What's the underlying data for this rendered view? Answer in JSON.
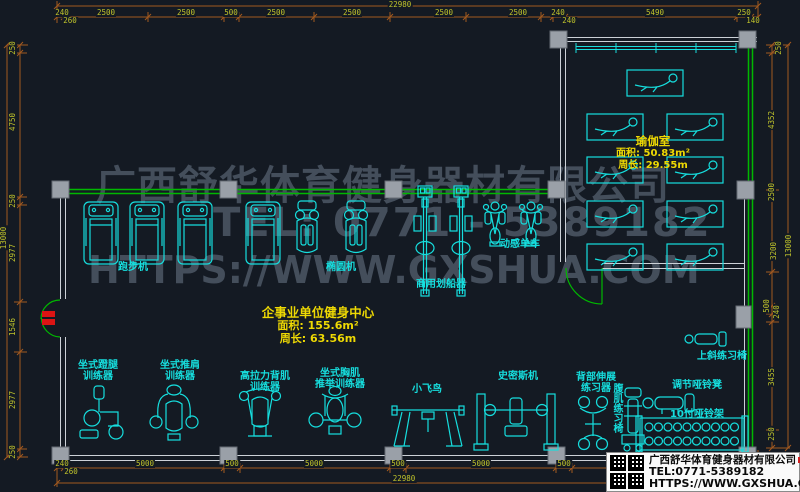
{
  "watermark": {
    "line1": "广西舒华体育健身器材有限公司",
    "line2": "TEL: 0771 - 5389182",
    "line3": "HTTPS://WWW.GXSHUA.COM"
  },
  "rooms": {
    "yoga": {
      "name": "瑜伽室",
      "area": "面积: 50.83m²",
      "perimeter": "周长: 29.55m"
    },
    "main": {
      "name": "企事业单位健身中心",
      "area": "面积: 155.6m²",
      "perimeter": "周长: 63.56m"
    }
  },
  "title_block": {
    "company": "广西舒华体育健身器材有限公司",
    "tel": "TEL:0771-5389182",
    "url": "HTTPS://WWW.GXSHUA.COM"
  },
  "equipment_labels": [
    {
      "text": "跑步机",
      "x": 133,
      "y": 262
    },
    {
      "text": "椭圆机",
      "x": 341,
      "y": 262
    },
    {
      "text": "商用划船器",
      "x": 441,
      "y": 279
    },
    {
      "text": "动感单车",
      "x": 520,
      "y": 239
    },
    {
      "text": "坐式蹬腿\n训练器",
      "x": 98,
      "y": 360
    },
    {
      "text": "坐式推肩\n训练器",
      "x": 180,
      "y": 360
    },
    {
      "text": "高拉力背肌\n训练器",
      "x": 265,
      "y": 371
    },
    {
      "text": "坐式胸肌\n推举训练器",
      "x": 340,
      "y": 368
    },
    {
      "text": "小飞鸟",
      "x": 427,
      "y": 384
    },
    {
      "text": "史密斯机",
      "x": 518,
      "y": 371
    },
    {
      "text": "背部伸展\n练习器",
      "x": 596,
      "y": 372
    },
    {
      "text": "腹肌练习椅",
      "x": 611,
      "y": 383,
      "v": true
    },
    {
      "text": "上斜练习椅",
      "x": 722,
      "y": 351
    },
    {
      "text": "调节哑铃凳",
      "x": 697,
      "y": 380
    },
    {
      "text": "10付哑铃架",
      "x": 697,
      "y": 409
    }
  ],
  "dim_labels": [
    {
      "t": "22980",
      "x": 400,
      "y": 5
    },
    {
      "t": "240",
      "x": 62,
      "y": 13
    },
    {
      "t": "260",
      "x": 70,
      "y": 21
    },
    {
      "t": "2500",
      "x": 106,
      "y": 13
    },
    {
      "t": "2500",
      "x": 186,
      "y": 13
    },
    {
      "t": "500",
      "x": 231,
      "y": 13
    },
    {
      "t": "2500",
      "x": 276,
      "y": 13
    },
    {
      "t": "2500",
      "x": 352,
      "y": 13
    },
    {
      "t": "2500",
      "x": 444,
      "y": 13
    },
    {
      "t": "2500",
      "x": 518,
      "y": 13
    },
    {
      "t": "240",
      "x": 558,
      "y": 13
    },
    {
      "t": "240",
      "x": 569,
      "y": 21
    },
    {
      "t": "5490",
      "x": 655,
      "y": 13
    },
    {
      "t": "250",
      "x": 744,
      "y": 13
    },
    {
      "t": "140",
      "x": 753,
      "y": 21
    },
    {
      "t": "240",
      "x": 62,
      "y": 464
    },
    {
      "t": "260",
      "x": 71,
      "y": 472
    },
    {
      "t": "5000",
      "x": 145,
      "y": 464
    },
    {
      "t": "500",
      "x": 232,
      "y": 464
    },
    {
      "t": "5000",
      "x": 314,
      "y": 464
    },
    {
      "t": "500",
      "x": 398,
      "y": 464
    },
    {
      "t": "5000",
      "x": 481,
      "y": 464
    },
    {
      "t": "500",
      "x": 564,
      "y": 464
    },
    {
      "t": "22980",
      "x": 404,
      "y": 479
    },
    {
      "t": "250",
      "x": 13,
      "y": 48,
      "r": 1
    },
    {
      "t": "4750",
      "x": 13,
      "y": 122,
      "r": 1
    },
    {
      "t": "250",
      "x": 13,
      "y": 201,
      "r": 1
    },
    {
      "t": "2977",
      "x": 13,
      "y": 253,
      "r": 1
    },
    {
      "t": "1546",
      "x": 13,
      "y": 327,
      "r": 1
    },
    {
      "t": "2977",
      "x": 13,
      "y": 400,
      "r": 1
    },
    {
      "t": "250",
      "x": 13,
      "y": 452,
      "r": 1
    },
    {
      "t": "13000",
      "x": 4,
      "y": 238,
      "r": 1
    },
    {
      "t": "250",
      "x": 779,
      "y": 48,
      "r": 1
    },
    {
      "t": "4352",
      "x": 772,
      "y": 120,
      "r": 1
    },
    {
      "t": "2500",
      "x": 772,
      "y": 192,
      "r": 1
    },
    {
      "t": "3200",
      "x": 774,
      "y": 251,
      "r": 1
    },
    {
      "t": "500",
      "x": 767,
      "y": 306,
      "r": 1
    },
    {
      "t": "240",
      "x": 777,
      "y": 312,
      "r": 1
    },
    {
      "t": "3455",
      "x": 772,
      "y": 377,
      "r": 1
    },
    {
      "t": "250",
      "x": 772,
      "y": 434,
      "r": 1
    },
    {
      "t": "13000",
      "x": 789,
      "y": 246,
      "r": 1
    }
  ],
  "colors": {
    "background": "#141a23",
    "equipment": "#16dede",
    "wall_green": "#00b800",
    "wall_white": "#ccd1d7",
    "column": "#9aa0a8",
    "door_red": "#dc1414",
    "dim_line": "#a2591f",
    "dim_text": "#bfc32b",
    "label_yellow": "#eed903",
    "watermark": "#47515f"
  }
}
